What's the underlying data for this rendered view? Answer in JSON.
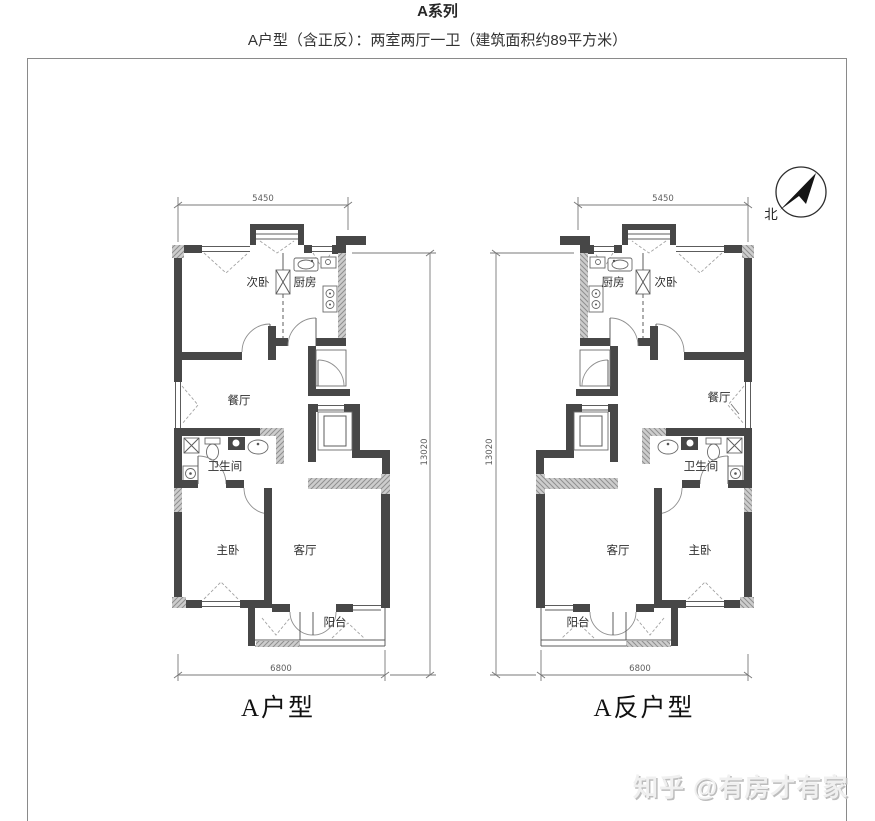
{
  "header": {
    "title": "A系列",
    "subtitle": "A户型（含正反）：两室两厅一卫（建筑面积约89平方米）"
  },
  "compass": {
    "north_label": "北"
  },
  "plans": [
    {
      "name": "A户型",
      "dims": {
        "width_top": "5450",
        "width_bottom": "6800",
        "height_side": "13020"
      },
      "rooms": {
        "secondary_bedroom": "次卧",
        "kitchen": "厨房",
        "dining_room": "餐厅",
        "bathroom": "卫生间",
        "master_bedroom": "主卧",
        "living_room": "客厅",
        "balcony": "阳台"
      }
    },
    {
      "name": "A反户型",
      "dims": {
        "width_top": "5450",
        "width_bottom": "6800",
        "height_side": "13020"
      },
      "rooms": {
        "secondary_bedroom": "次卧",
        "kitchen": "厨房",
        "dining_room": "餐厅",
        "bathroom": "卫生间",
        "master_bedroom": "主卧",
        "living_room": "客厅",
        "balcony": "阳台"
      }
    }
  ],
  "watermark": "知乎 @有房才有家",
  "colors": {
    "wall": "#474747",
    "wall_hatch": "#cdcdcd",
    "dimension_line": "#787878",
    "frame_border": "#8a8a8a",
    "text": "#333333"
  }
}
